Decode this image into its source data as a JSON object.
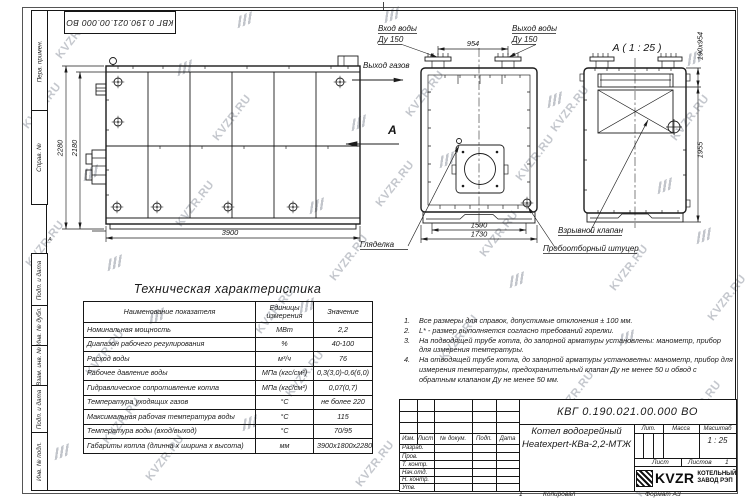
{
  "page": {
    "watermark": "KVZR.RU",
    "top_doc_number": "КВГ 0.190.021.00.000 ВО",
    "copied_label": "Копировал",
    "format_label": "Формат А3",
    "zone_left": "А",
    "zone_bottom": "1"
  },
  "frame": {
    "left_labels": [
      "Перв. примен.",
      "Справ. №",
      "Подп. и дата",
      "Инв. № дубл.",
      "Взам. инв. №",
      "Подп. и дата",
      "Инв. № подл."
    ]
  },
  "drawing": {
    "view_a_title": "А ( 1 : 25 )",
    "view_arrow_label": "А",
    "labels": {
      "water_inlet_1": "Вход воды",
      "water_inlet_2": "Ду 150",
      "water_outlet_1": "Выход воды",
      "water_outlet_2": "Ду 150",
      "gas_outlet": "Выход газов",
      "sight_glass": "Гляделка",
      "explosion_valve": "Взрывной клапан",
      "sampling_fitting": "Пробоотборный штуцер"
    },
    "dimensions": {
      "top_nozzles": "954",
      "height_outer": "2280",
      "height_inner": "2180",
      "length": "3900",
      "width_inner": "1590",
      "width_outer": "1730",
      "gas_opening": "190х954",
      "side_height": "1955"
    }
  },
  "spec_table": {
    "title": "Техническая характеристика",
    "headers": [
      "Наименование показателя",
      "Единицы измерения",
      "Значение"
    ],
    "rows": [
      [
        "Номинальная мощность",
        "МВт",
        "2,2"
      ],
      [
        "Диапазон рабочего регулирования",
        "%",
        "40-100"
      ],
      [
        "Расход воды",
        "м³/ч",
        "76"
      ],
      [
        "Рабочее давление воды",
        "МПа (кгс/см²)",
        "0,3(3,0)-0,6(6,0)"
      ],
      [
        "Гидравлическое сопротивление котла",
        "МПа (кгс/см²)",
        "0,07(0,7)"
      ],
      [
        "Температура уходящих газов",
        "°С",
        "не более 220"
      ],
      [
        "Максимальная рабочая температура воды",
        "°С",
        "115"
      ],
      [
        "Температура воды (вход/выход)",
        "°С",
        "70/95"
      ],
      [
        "Габариты котла (длинна х ширина х высота)",
        "мм",
        "3900х1800х2280"
      ]
    ]
  },
  "notes": {
    "items": [
      {
        "n": "1.",
        "text": "Все размеры для справок, допустимые отклонения ± 100 мм."
      },
      {
        "n": "2.",
        "text": "L* - размер выполняется согласно требований горелки."
      },
      {
        "n": "3.",
        "text": "На подводящей трубе котла, до запорной арматуры установлены: манометр, прибор для измерения температуры."
      },
      {
        "n": "4.",
        "text": "На отводящей трубе котла, до запорной арматуры установелны: манометр, прибор для измерения температуры, предохранительный клапан Ду не менее 50 и обвод с обратным клапаном Ду не менее 50 мм."
      }
    ]
  },
  "title_block": {
    "doc_number": "КВГ 0.190.021.00.000 ВО",
    "product_name_line1": "Котел водогрейный",
    "product_name_line2": "Heatexpert-КВа-2,2-МТЖ",
    "cols": {
      "izm": "Изм.",
      "list": "Лист",
      "ndoc": "№ докум.",
      "podp": "Подп.",
      "data": "Дата"
    },
    "rows": [
      "Разраб.",
      "Пров.",
      "Т. контр.",
      "Нач.отд.",
      "Н. контр.",
      "Утв."
    ],
    "lit": "Лит.",
    "mass": "Масса",
    "scale": "Масштаб",
    "scale_value": "1 : 25",
    "sheet": "Лист",
    "sheets": "Листов",
    "sheets_value": "1",
    "brand": "KVZR",
    "brand_line1": "КОТЕЛЬНЫЙ",
    "brand_line2": "ЗАВОД РЭП"
  }
}
